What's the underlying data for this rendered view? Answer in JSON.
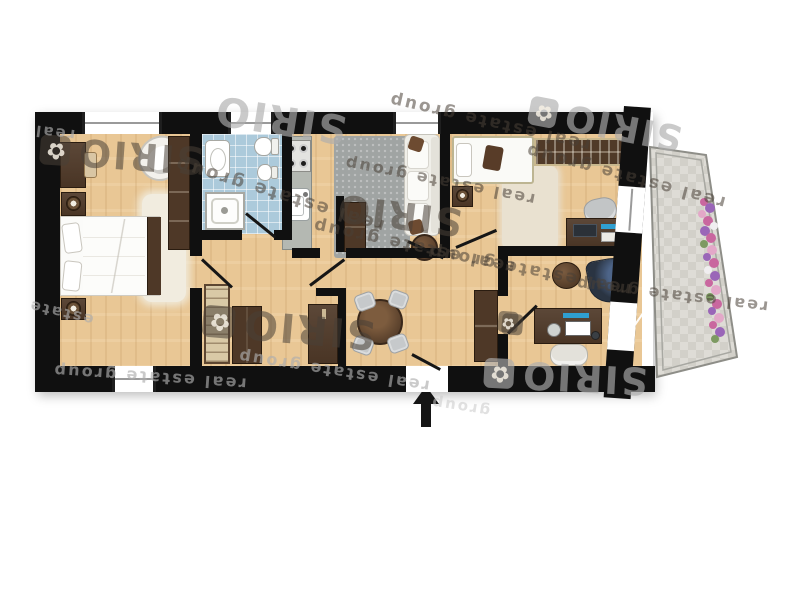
{
  "watermark": {
    "brand": "SIRIO",
    "tagline": "real estate group",
    "logo_glyph": "✿",
    "instances": [
      {
        "type": "brand",
        "x": 40,
        "y": 134,
        "size": 38,
        "rot": 184,
        "tone": "dark",
        "logo": true
      },
      {
        "type": "brand",
        "x": 214,
        "y": 98,
        "size": 40,
        "rot": 189,
        "tone": "light",
        "logo": false
      },
      {
        "type": "brand",
        "x": 336,
        "y": 194,
        "size": 38,
        "rot": 187,
        "tone": "dark",
        "logo": false
      },
      {
        "type": "brand",
        "x": 203,
        "y": 306,
        "size": 40,
        "rot": 185,
        "tone": "dark",
        "logo": true
      },
      {
        "type": "brand",
        "x": 484,
        "y": 356,
        "size": 38,
        "rot": 183,
        "tone": "light",
        "logo": true
      },
      {
        "type": "brand",
        "x": 528,
        "y": 104,
        "size": 36,
        "rot": 191,
        "tone": "light",
        "logo": true
      },
      {
        "type": "logo",
        "x": 497,
        "y": 314,
        "size": 26,
        "rot": 185,
        "tone": "dark"
      },
      {
        "type": "phrase",
        "x": 386,
        "y": 112,
        "size": 17,
        "rot": 193,
        "tone": "dark"
      },
      {
        "type": "phrase",
        "x": 170,
        "y": 184,
        "size": 18,
        "rot": 197,
        "tone": "dark"
      },
      {
        "type": "phrase",
        "x": 34,
        "y": 124,
        "size": 15,
        "rot": 187,
        "tone": "light",
        "word": "real"
      },
      {
        "type": "phrase",
        "x": 310,
        "y": 236,
        "size": 17,
        "rot": 192,
        "tone": "dark"
      },
      {
        "type": "phrase",
        "x": 52,
        "y": 368,
        "size": 16,
        "rot": 184,
        "tone": "light"
      },
      {
        "type": "phrase",
        "x": 236,
        "y": 362,
        "size": 16,
        "rot": 189,
        "tone": "light"
      },
      {
        "type": "phrase",
        "x": 522,
        "y": 166,
        "size": 17,
        "rot": 195,
        "tone": "dark"
      },
      {
        "type": "phrase",
        "x": 426,
        "y": 260,
        "size": 17,
        "rot": 191,
        "tone": "dark"
      },
      {
        "type": "phrase",
        "x": 574,
        "y": 286,
        "size": 16,
        "rot": 187,
        "tone": "dark"
      },
      {
        "type": "phrase",
        "x": 342,
        "y": 172,
        "size": 16,
        "rot": 191,
        "tone": "dark"
      },
      {
        "type": "phrase",
        "x": 430,
        "y": 398,
        "size": 15,
        "rot": 189,
        "tone": "faint",
        "word": "group"
      },
      {
        "type": "phrase",
        "x": 28,
        "y": 304,
        "size": 15,
        "rot": 193,
        "tone": "light",
        "word": "estate"
      }
    ]
  },
  "colors": {
    "wall": "#101010",
    "floor_wood": "#e9c795",
    "bathroom_tile": "#accadb",
    "balcony_tile": "#dedcd6",
    "counter_gray": "#b4b8b2",
    "furniture_brown": "#4e3827",
    "accent_blue": "#2f9fd0",
    "flower_pink": "#c9679f",
    "flower_purple": "#9a66b8",
    "watermark_dark": "rgba(72,64,54,0.55)",
    "watermark_light": "rgba(173,173,173,0.65)",
    "watermark_faint": "rgba(200,200,200,0.55)"
  },
  "icons": {
    "entrance_arrow": "up-arrow",
    "sirio_logo": "flower-clover"
  }
}
